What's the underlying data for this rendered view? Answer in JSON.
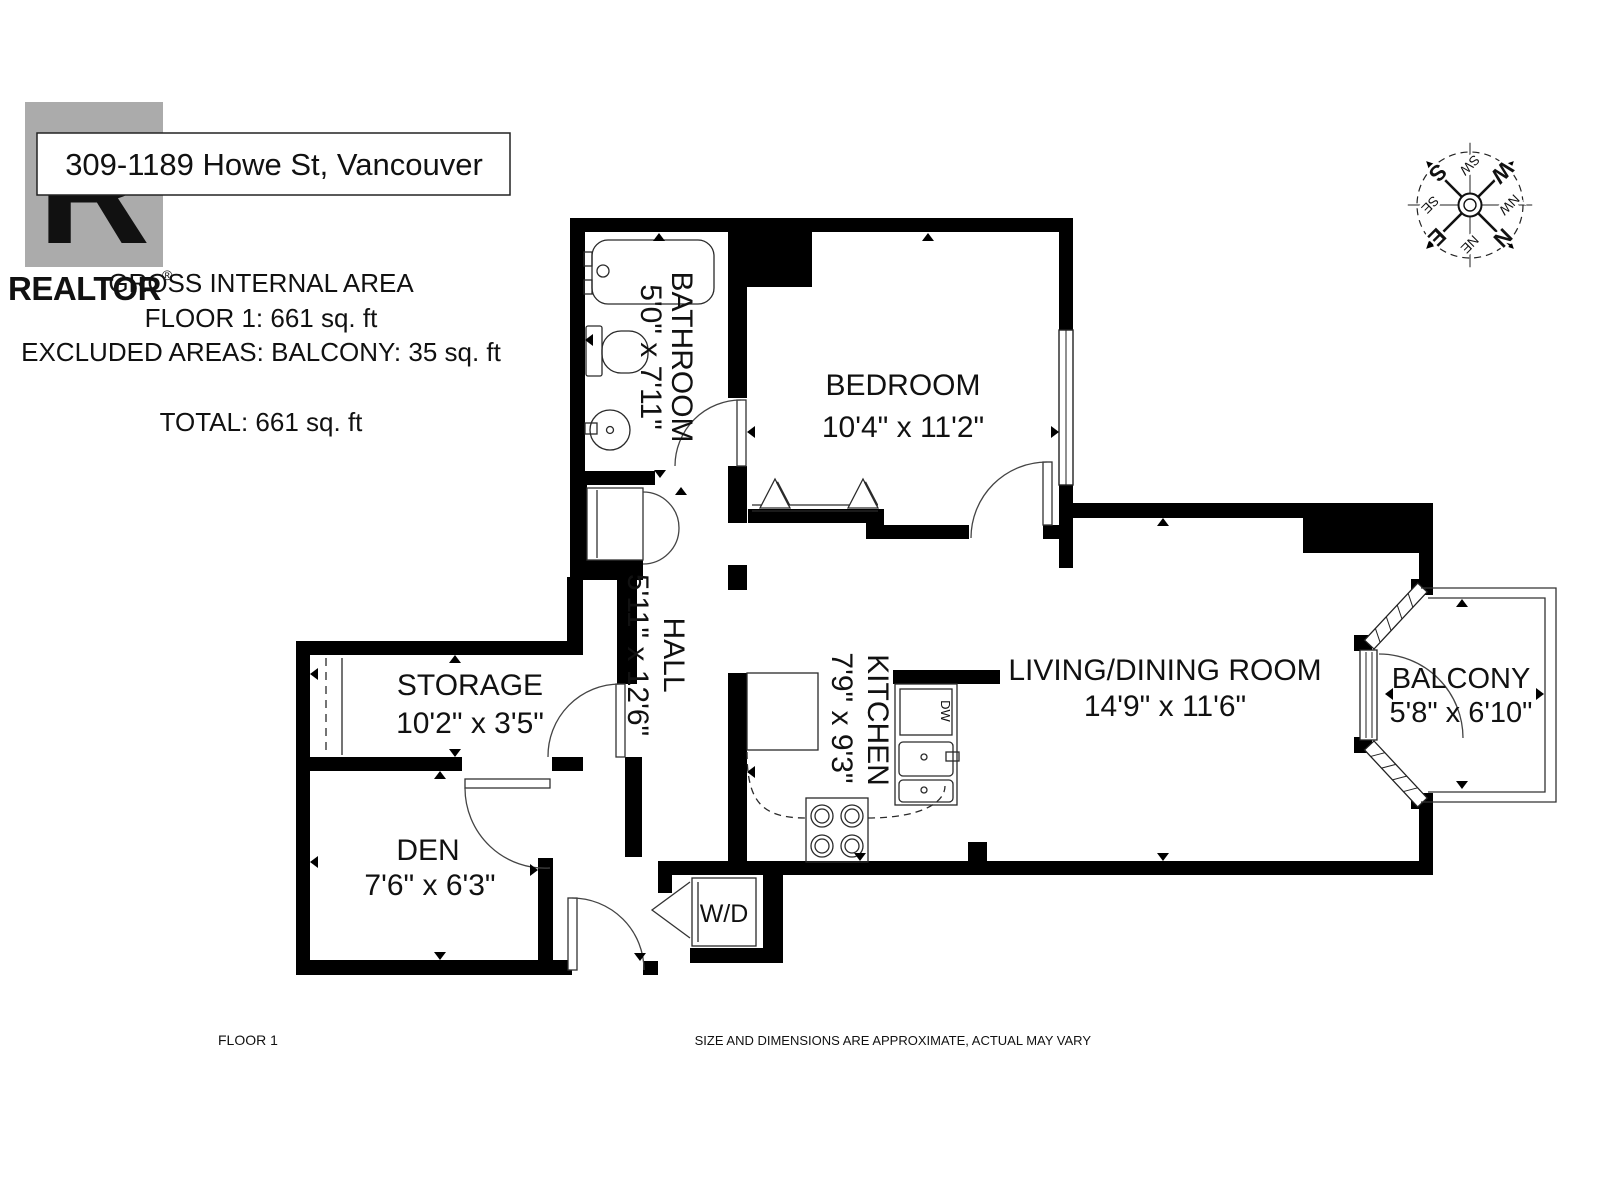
{
  "header": {
    "address": "309-1189 Howe St, Vancouver",
    "logo": {
      "letter": "R",
      "name": "REALTOR",
      "registered": "®"
    }
  },
  "area_summary": {
    "heading": "GROSS INTERNAL AREA",
    "floor_line": "FLOOR 1:  661 sq. ft",
    "excluded_line": "EXCLUDED AREAS:  BALCONY: 35 sq. ft",
    "total_line": "TOTAL: 661 sq. ft"
  },
  "compass": {
    "rotation_deg": 135,
    "n": "N",
    "e": "E",
    "s": "S",
    "w": "W",
    "ne": "NE",
    "se": "SE",
    "sw": "SW",
    "nw": "NW"
  },
  "rooms": [
    {
      "id": "bathroom",
      "name": "BATHROOM",
      "dims": "5'0\" x 7'11\""
    },
    {
      "id": "bedroom",
      "name": "BEDROOM",
      "dims": "10'4\" x 11'2\""
    },
    {
      "id": "storage",
      "name": "STORAGE",
      "dims": "10'2\" x 3'5\""
    },
    {
      "id": "hall",
      "name": "HALL",
      "dims": "5'11\" x 12'6\""
    },
    {
      "id": "den",
      "name": "DEN",
      "dims": "7'6\" x 6'3\""
    },
    {
      "id": "kitchen",
      "name": "KITCHEN",
      "dims": "7'9\" x 9'3\""
    },
    {
      "id": "living",
      "name": "LIVING/DINING ROOM",
      "dims": "14'9\" x 11'6\""
    },
    {
      "id": "balcony",
      "name": "BALCONY",
      "dims": "5'8\" x 6'10\""
    }
  ],
  "appliances": {
    "washer_dryer": "W/D",
    "dishwasher": "DW"
  },
  "footer": {
    "floor_label": "FLOOR 1",
    "disclaimer": "SIZE AND DIMENSIONS ARE APPROXIMATE, ACTUAL MAY VARY"
  },
  "colors": {
    "wall": "#000000",
    "watermark": "#ababab",
    "muted_text": "#9b9b9b"
  }
}
